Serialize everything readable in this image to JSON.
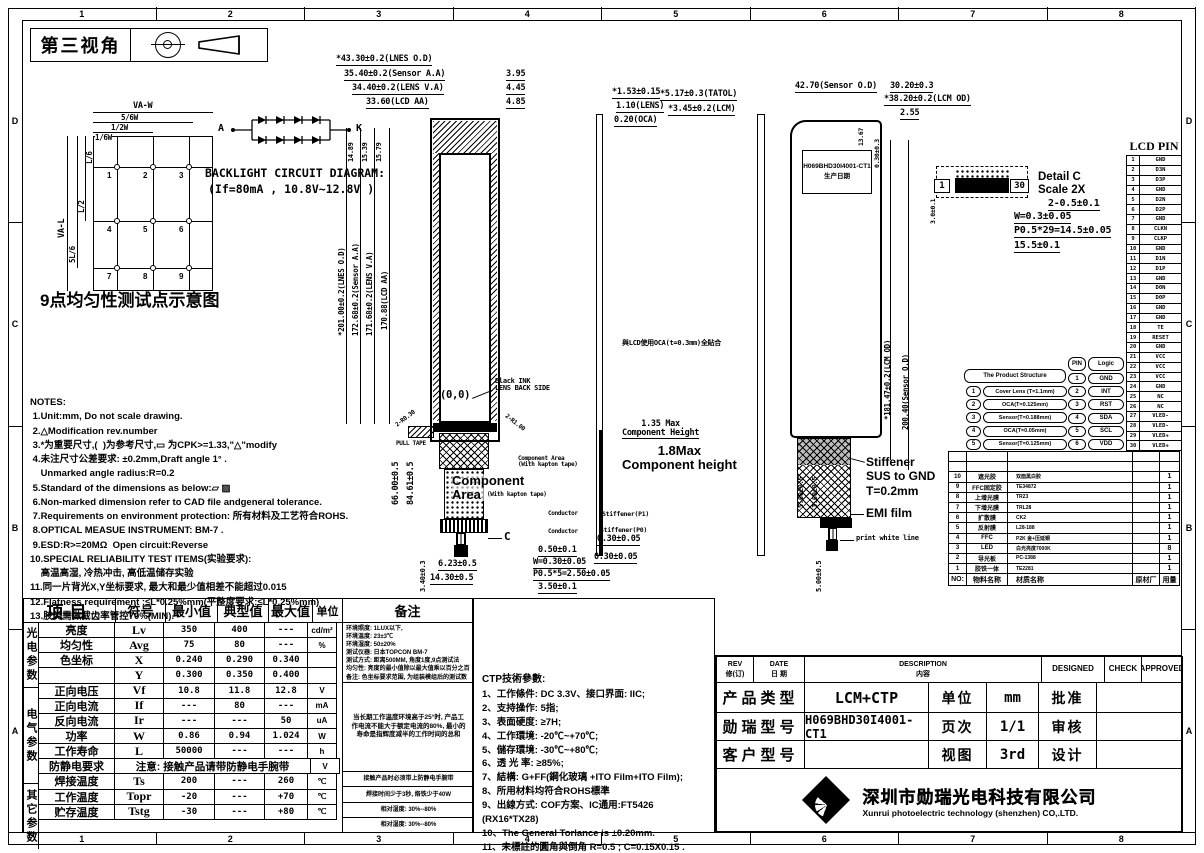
{
  "frame": {
    "cols": [
      "1",
      "2",
      "3",
      "4",
      "5",
      "6",
      "7",
      "8"
    ],
    "rows": [
      "D",
      "C",
      "B",
      "A"
    ]
  },
  "header": {
    "view_angle": "第三视角"
  },
  "uniformity": {
    "title": "9点均匀性测试点示意图",
    "points": [
      "1",
      "2",
      "3",
      "4",
      "5",
      "6",
      "7",
      "8",
      "9"
    ],
    "dims_top": [
      "VA-W",
      "5/6W",
      "1/2W",
      "1/6W"
    ],
    "dims_left": [
      "VA-L",
      "5L/6",
      "L/2",
      "L/6"
    ]
  },
  "backlight": {
    "title": "BACKLIGHT CIRCUIT DIAGRAM:",
    "condition": "(If=80mA ,  10.8V~12.8V )",
    "anode": "A",
    "cathode": "K"
  },
  "notes": {
    "lines": [
      "NOTES:",
      " 1.Unit:mm, Do not scale drawing.",
      " 2.△Modification rev.number",
      " 3.*为重要尺寸,(  )为参考尺寸,▭ 为CPK>=1.33,\"△\"modify",
      " 4.未注尺寸公差要求: ±0.2mm,Draft angle 1° .",
      "    Unmarked angle radius:R=0.2",
      " 5.Standard of the dimensions as below:▱ ▨",
      " 6.Non-marked dimension refer to CAD file andgeneral tolerance.",
      " 7.Requirements on environment protection: 所有材料及工艺符合ROHS.",
      " 8.OPTICAL MEASUE INSTRUMENT: BM-7 .",
      " 9.ESD:R>=20MΩ  Open circuit:Reverse",
      "10.SPECIAL RELIABILITY TEST ITEMS(实验要求):",
      "    高温高湿, 冷热冲击, 高低温储存实验",
      "11.同一片背光X,Y坐标要求, 最大和最少值相差不能超过0.015",
      "12.Flatness requirement :≤L*0.25%mm(平整度要求:≤L*0.25%mm)",
      "13.胶类需做截齿率管控70%(MIN)."
    ]
  },
  "front_view": {
    "dim_lens_od": "*43.30±0.2(LNES O.D)",
    "dim_sensor_aa": "35.40±0.2(Sensor A.A)",
    "dim_lens_va": "34.40±0.2(LENS V.A)",
    "dim_lcd_aa": "33.60(LCD AA)",
    "dim_r1": "3.95",
    "dim_r2": "4.45",
    "dim_r3": "4.85",
    "dim_t1": "14.89",
    "dim_t2": "15.39",
    "dim_t3": "15.79",
    "dim_v_lens_od": "*201.00±0.2(LNES O.D)",
    "dim_v_sensor": "172.68±0.2(Sensor A.A)",
    "dim_v_lens_va": "171.68±0.2(LENS V.A)",
    "dim_v_lcd": "170.88(LCD AA)",
    "origin": "(0,0)",
    "black_ink": "Black INK\nLENS BACK SIDE",
    "pull_tape": "PULL TAPE",
    "r_left": "2-R0.30",
    "r_right": "2-R1.00",
    "dim_66": "66.00±0.5",
    "dim_84": "84.61±0.5",
    "comp_area_small": "Component Area\n(With kapton tape)",
    "comp_area_big": "Component\nArea",
    "comp_area_big_suffix": "(With kapton tape)",
    "callout_c": "C",
    "dim_b1": "0.50±0.1",
    "dim_b2": "W=0.30±0.05",
    "dim_b3": "P0.5*5=2.50±0.05",
    "dim_b4": "3.50±0.1",
    "dim_b5": "6.23±0.5",
    "dim_b6": "14.30±0.5",
    "dim_b7": "3.40±0.3"
  },
  "side_view": {
    "dim_total": "*1.53±0.15",
    "dim_lens": "1.10(LENS)",
    "dim_oca": "0.20(OCA)",
    "oca_note": "與LCD使用OCA(t=0.3mm)全貼合",
    "comp_h1": "1.35 Max\nComponent Height",
    "comp_h2": "1.8Max\nComponent height",
    "conductor1": "Conductor",
    "conductor2": "Conductor",
    "stiffener_p1": "Stiffener(P1)",
    "stiffener_p0": "Stiffener(P0)",
    "dim_030a": "0.30±0.05",
    "dim_030b": "0.30±0.05"
  },
  "back_view": {
    "dim_total": "*5.17±0.3(TATOL)",
    "dim_lcm": "*3.45±0.2(LCM)",
    "dim_sensor_od": "42.70(Sensor O.D)",
    "dim_3020": "30.20±0.3",
    "dim_lcm_od": "*38.20±0.2(LCM OD)",
    "dim_255": "2.55",
    "dim_1367": "13.67",
    "dim_030": "0.30±0.3",
    "dim_v_lcm": "*181.47±0.2(LCM OD)",
    "dim_v_sensor": "200.40(Sensor O.D)",
    "label_model": "H069BHD30I4001-CT1",
    "label_date": "生产日期",
    "stiffener_note": "Stiffener\nSUS to GND\nT=0.2mm",
    "emi": "EMI film",
    "white_line": "print white line",
    "dim_f1": "5.00±0.5",
    "dim_f2": "3.00±0.5",
    "dim_f3": "5.00±0.5"
  },
  "detail_c": {
    "pin1": "1",
    "pin30": "30",
    "title": "Detail C",
    "scale": "Scale 2X",
    "d1": "2-0.5±0.1",
    "d2": "W=0.3±0.05",
    "d3": "P0.5*29=14.5±0.05",
    "d4": "15.5±0.1",
    "d5": "3.0±0.1"
  },
  "lcd_pin": {
    "title": "LCD PIN",
    "rows": [
      {
        "no": "1",
        "name": "GND"
      },
      {
        "no": "2",
        "name": "D3N"
      },
      {
        "no": "3",
        "name": "D3P"
      },
      {
        "no": "4",
        "name": "GND"
      },
      {
        "no": "5",
        "name": "D2N"
      },
      {
        "no": "6",
        "name": "D2P"
      },
      {
        "no": "7",
        "name": "GND"
      },
      {
        "no": "8",
        "name": "CLKN"
      },
      {
        "no": "9",
        "name": "CLKP"
      },
      {
        "no": "10",
        "name": "GND"
      },
      {
        "no": "11",
        "name": "D1N"
      },
      {
        "no": "12",
        "name": "D1P"
      },
      {
        "no": "13",
        "name": "GND"
      },
      {
        "no": "14",
        "name": "D0N"
      },
      {
        "no": "15",
        "name": "D0P"
      },
      {
        "no": "16",
        "name": "GND"
      },
      {
        "no": "17",
        "name": "GND"
      },
      {
        "no": "18",
        "name": "TE"
      },
      {
        "no": "19",
        "name": "RESET"
      },
      {
        "no": "20",
        "name": "GND"
      },
      {
        "no": "21",
        "name": "VCC"
      },
      {
        "no": "22",
        "name": "VCC"
      },
      {
        "no": "23",
        "name": "VCC"
      },
      {
        "no": "24",
        "name": "GND"
      },
      {
        "no": "25",
        "name": "NC"
      },
      {
        "no": "26",
        "name": "NC"
      },
      {
        "no": "27",
        "name": "VLED-"
      },
      {
        "no": "28",
        "name": "VLED-"
      },
      {
        "no": "29",
        "name": "VLED+"
      },
      {
        "no": "30",
        "name": "VLED+"
      }
    ]
  },
  "product_structure": {
    "title": "The Product Structure",
    "rows": [
      {
        "no": "1",
        "label": "Cover Lens (T=1.1mm)"
      },
      {
        "no": "2",
        "label": "OCA(T=0.125mm)"
      },
      {
        "no": "3",
        "label": "Sensor(T=0.188mm)"
      },
      {
        "no": "4",
        "label": "OCA(T=0.05mm)"
      },
      {
        "no": "5",
        "label": "Sensor(T=0.125mm)"
      }
    ]
  },
  "ctp_pin": {
    "pin_header": "PIN",
    "logic_header": "Logic",
    "rows": [
      {
        "no": "1",
        "name": "GND"
      },
      {
        "no": "2",
        "name": "INT"
      },
      {
        "no": "3",
        "name": "RST"
      },
      {
        "no": "4",
        "name": "SDA"
      },
      {
        "no": "5",
        "name": "SCL"
      },
      {
        "no": "6",
        "name": "VDD"
      }
    ]
  },
  "bom": {
    "rows": [
      {
        "no": "",
        "name": "",
        "material": "",
        "supplier": "",
        "qty": ""
      },
      {
        "no": "",
        "name": "",
        "material": "",
        "supplier": "",
        "qty": ""
      },
      {
        "no": "10",
        "name": "遮光胶",
        "material": "双面黑白胶",
        "supplier": "",
        "qty": "1"
      },
      {
        "no": "9",
        "name": "FFC固定胶",
        "material": "TE34872",
        "supplier": "",
        "qty": "1"
      },
      {
        "no": "8",
        "name": "上增光膜",
        "material": "TR23",
        "supplier": "",
        "qty": "1"
      },
      {
        "no": "7",
        "name": "下增光膜",
        "material": "TRL28",
        "supplier": "",
        "qty": "1"
      },
      {
        "no": "6",
        "name": "扩散膜",
        "material": "CK2",
        "supplier": "",
        "qty": "1"
      },
      {
        "no": "5",
        "name": "反射膜",
        "material": "L28-188",
        "supplier": "",
        "qty": "1"
      },
      {
        "no": "4",
        "name": "FFC",
        "material": "P2K 金+压延铜",
        "supplier": "",
        "qty": "1"
      },
      {
        "no": "3",
        "name": "LED",
        "material": "白光亮度7000K",
        "supplier": "",
        "qty": "8"
      },
      {
        "no": "2",
        "name": "导光板",
        "material": "PC-1388",
        "supplier": "",
        "qty": "1"
      },
      {
        "no": "1",
        "name": "胶铁一体",
        "material": "TE2281",
        "supplier": "",
        "qty": "1"
      }
    ],
    "footer": {
      "no": "NO:",
      "name": "物料名称",
      "material": "材质名称",
      "supplier": "原材厂",
      "qty": "用量"
    }
  },
  "params": {
    "headers": {
      "item": "项目",
      "symbol": "符号",
      "min": "最小值",
      "typ": "典型值",
      "max": "最大值",
      "unit": "单位",
      "remark": "备注"
    },
    "group_photometric": "光电参数",
    "group_electric": "电气参数",
    "group_other": "其它参数",
    "photometric_rows": [
      {
        "name": "亮度",
        "symbol": "Lv",
        "min": "350",
        "typ": "400",
        "max": "---",
        "unit": "cd/m²"
      },
      {
        "name": "均匀性",
        "symbol": "Avg",
        "min": "75",
        "typ": "80",
        "max": "---",
        "unit": "%"
      },
      {
        "name": "色坐标",
        "symbol": "X",
        "min": "0.240",
        "typ": "0.290",
        "max": "0.340",
        "unit": ""
      },
      {
        "name": "",
        "symbol": "Y",
        "min": "0.300",
        "typ": "0.350",
        "max": "0.400",
        "unit": ""
      }
    ],
    "electric_rows": [
      {
        "name": "正向电压",
        "symbol": "Vf",
        "min": "10.8",
        "typ": "11.8",
        "max": "12.8",
        "unit": "V"
      },
      {
        "name": "正向电流",
        "symbol": "If",
        "min": "---",
        "typ": "80",
        "max": "---",
        "unit": "mA"
      },
      {
        "name": "反向电流",
        "symbol": "Ir",
        "min": "---",
        "typ": "---",
        "max": "50",
        "unit": "uA"
      },
      {
        "name": "功率",
        "symbol": "W",
        "min": "0.86",
        "typ": "0.94",
        "max": "1.024",
        "unit": "W"
      },
      {
        "name": "工作寿命",
        "symbol": "L",
        "min": "50000",
        "typ": "---",
        "max": "---",
        "unit": "h"
      }
    ],
    "antistatic_row": {
      "name": "防静电要求",
      "notice": "注意: 接触产品请带防静电手腕带",
      "unit": "V"
    },
    "other_rows": [
      {
        "name": "焊接温度",
        "symbol": "Ts",
        "min": "200",
        "typ": "---",
        "max": "260",
        "unit": "℃"
      },
      {
        "name": "工作温度",
        "symbol": "Topr",
        "min": "-20",
        "typ": "---",
        "max": "+70",
        "unit": "℃"
      },
      {
        "name": "贮存温度",
        "symbol": "Tstg",
        "min": "-30",
        "typ": "---",
        "max": "+80",
        "unit": "℃"
      }
    ],
    "remarks": {
      "photometric": "环境照度: 1LUX以下,\n环境温度: 23±3℃\n环境湿度: 50±20%\n测试仪器: 日本TOPCON BM-7\n测试方式: 距离500MM, 角度1度,9点测试法\n均匀性: 亮度的最小值除以最大值乘以百分之百\n备注: 色坐标要求范围, 为组装模组后的测试数据",
      "electric": "当长期工作温度环境高于25°时, 产品工作电流不能大于额定电流的80%, 最小的寿命是指辉度减半的工作时间的总和",
      "antistatic": "接触产品时必须带上防静电手腕带",
      "solder": "焊接时间少于3秒, 烙铁少于40W",
      "operating": "相对湿度: 30%--80%",
      "storage": "相对湿度: 30%--80%"
    }
  },
  "ctp_spec": {
    "title": "CTP技術參數:",
    "lines": [
      "1、工作條件: DC 3.3V、接口界面: IIC;",
      "2、支持操作: 5指;",
      "3、表面硬度: ≥7H;",
      "4、工作環境: -20℃~+70℃;",
      "5、儲存環境: -30℃~+80℃;",
      "6、透 光 率: ≥85%;",
      "7、結構: G+FF(鋼化玻璃 +ITO Film+ITO Film);",
      "8、所用材料均符合ROHS標準",
      "9、出線方式: COF方案、IC通用:FT5426 (RX16*TX28)",
      "10、The General Torlance is ±0.20mm.",
      "11、未標註的圓角與倒角 R=0.5 ; C=0.15X0.15 ."
    ]
  },
  "title_block": {
    "rev": "REV\n修(订)",
    "date": "DATE\n日 期",
    "description": "DESCRIPTION\n内容",
    "designed": "DESIGNED",
    "check": "CHECK",
    "approved": "APPROVED",
    "product_type_label": "产品类型",
    "product_type": "LCM+CTP",
    "unit_label": "单位",
    "unit": "mm",
    "approve_label": "批准",
    "model_label": "勋瑞型号",
    "model": "H069BHD30I4001-CT1",
    "page_label": "页次",
    "page": "1/1",
    "review_label": "审核",
    "customer_label": "客户型号",
    "customer_model": "",
    "view_label": "视图",
    "view": "3rd",
    "design_label": "设计"
  },
  "company": {
    "name_cn": "深圳市勋瑞光电科技有限公司",
    "name_en": "Xunrui photoelectric technology (shenzhen) CO,.LTD."
  }
}
